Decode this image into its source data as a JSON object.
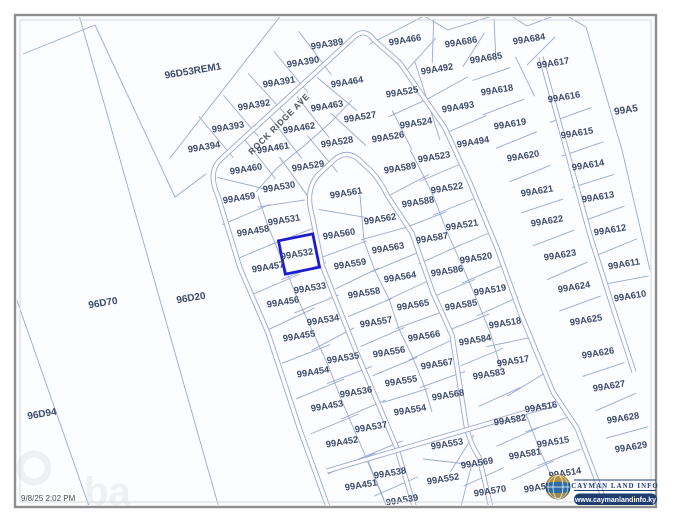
{
  "map": {
    "road_label": "ROCK RIDGE AVE",
    "highlight_parcel": "99A532",
    "colors": {
      "parcel_line": "#9aa8d4",
      "road_fill": "#ffffff",
      "highlight": "#1d1dcf",
      "label_text": "#3e4a6b",
      "frame": "#8e8e8e",
      "logo_navy": "#1e3c6e",
      "globe_blue": "#2d6ca5",
      "globe_gold": "#c9982f"
    },
    "parcels": [
      {
        "id": "96D53REM1",
        "x": 193,
        "y": 71,
        "s": 10
      },
      {
        "id": "96D70",
        "x": 103,
        "y": 303,
        "s": 10
      },
      {
        "id": "96D20",
        "x": 191,
        "y": 298,
        "s": 10
      },
      {
        "id": "96D94",
        "x": 42,
        "y": 414,
        "s": 10
      },
      {
        "id": "99A5",
        "x": 626,
        "y": 110,
        "s": 10
      },
      {
        "id": "99A389",
        "x": 327,
        "y": 44
      },
      {
        "id": "99A390",
        "x": 303,
        "y": 62
      },
      {
        "id": "99A391",
        "x": 279,
        "y": 82
      },
      {
        "id": "99A392",
        "x": 254,
        "y": 105
      },
      {
        "id": "99A393",
        "x": 228,
        "y": 127
      },
      {
        "id": "99A394",
        "x": 204,
        "y": 147
      },
      {
        "id": "99A464",
        "x": 347,
        "y": 82
      },
      {
        "id": "99A463",
        "x": 327,
        "y": 106
      },
      {
        "id": "99A462",
        "x": 299,
        "y": 128
      },
      {
        "id": "99A461",
        "x": 273,
        "y": 148
      },
      {
        "id": "99A460",
        "x": 246,
        "y": 169
      },
      {
        "id": "99A459",
        "x": 239,
        "y": 198
      },
      {
        "id": "99A458",
        "x": 253,
        "y": 231
      },
      {
        "id": "99A457",
        "x": 268,
        "y": 267
      },
      {
        "id": "99A456",
        "x": 283,
        "y": 302
      },
      {
        "id": "99A455",
        "x": 299,
        "y": 336
      },
      {
        "id": "99A454",
        "x": 313,
        "y": 372
      },
      {
        "id": "99A453",
        "x": 327,
        "y": 406
      },
      {
        "id": "99A452",
        "x": 342,
        "y": 442
      },
      {
        "id": "99A451",
        "x": 361,
        "y": 485
      },
      {
        "id": "99A529",
        "x": 308,
        "y": 166
      },
      {
        "id": "99A530",
        "x": 279,
        "y": 187
      },
      {
        "id": "99A531",
        "x": 284,
        "y": 220
      },
      {
        "id": "99A532",
        "x": 297,
        "y": 254
      },
      {
        "id": "99A533",
        "x": 310,
        "y": 288
      },
      {
        "id": "99A534",
        "x": 323,
        "y": 320
      },
      {
        "id": "99A535",
        "x": 343,
        "y": 358
      },
      {
        "id": "99A536",
        "x": 356,
        "y": 392
      },
      {
        "id": "99A537",
        "x": 371,
        "y": 427
      },
      {
        "id": "99A538",
        "x": 390,
        "y": 473
      },
      {
        "id": "99A539",
        "x": 402,
        "y": 500
      },
      {
        "id": "99A527",
        "x": 360,
        "y": 117
      },
      {
        "id": "99A528",
        "x": 337,
        "y": 142
      },
      {
        "id": "99A525",
        "x": 402,
        "y": 92
      },
      {
        "id": "99A524",
        "x": 416,
        "y": 123
      },
      {
        "id": "99A526",
        "x": 388,
        "y": 137
      },
      {
        "id": "99A492",
        "x": 437,
        "y": 69
      },
      {
        "id": "99A493",
        "x": 458,
        "y": 107
      },
      {
        "id": "99A494",
        "x": 473,
        "y": 142
      },
      {
        "id": "99A466",
        "x": 405,
        "y": 40
      },
      {
        "id": "99A686",
        "x": 461,
        "y": 42
      },
      {
        "id": "99A685",
        "x": 486,
        "y": 58
      },
      {
        "id": "99A684",
        "x": 529,
        "y": 39
      },
      {
        "id": "99A561",
        "x": 346,
        "y": 193
      },
      {
        "id": "99A560",
        "x": 339,
        "y": 234
      },
      {
        "id": "99A559",
        "x": 350,
        "y": 264
      },
      {
        "id": "99A558",
        "x": 364,
        "y": 293
      },
      {
        "id": "99A557",
        "x": 376,
        "y": 322
      },
      {
        "id": "99A556",
        "x": 389,
        "y": 352
      },
      {
        "id": "99A555",
        "x": 401,
        "y": 381
      },
      {
        "id": "99A554",
        "x": 410,
        "y": 410
      },
      {
        "id": "99A553",
        "x": 447,
        "y": 444
      },
      {
        "id": "99A552",
        "x": 443,
        "y": 479
      },
      {
        "id": "99A562",
        "x": 380,
        "y": 219
      },
      {
        "id": "99A563",
        "x": 388,
        "y": 248
      },
      {
        "id": "99A564",
        "x": 400,
        "y": 277
      },
      {
        "id": "99A565",
        "x": 413,
        "y": 305
      },
      {
        "id": "99A566",
        "x": 424,
        "y": 336
      },
      {
        "id": "99A567",
        "x": 437,
        "y": 364
      },
      {
        "id": "99A568",
        "x": 448,
        "y": 395
      },
      {
        "id": "99A569",
        "x": 477,
        "y": 463
      },
      {
        "id": "99A570",
        "x": 490,
        "y": 491
      },
      {
        "id": "99A589",
        "x": 400,
        "y": 168
      },
      {
        "id": "99A588",
        "x": 418,
        "y": 202
      },
      {
        "id": "99A587",
        "x": 432,
        "y": 238
      },
      {
        "id": "99A586",
        "x": 447,
        "y": 271
      },
      {
        "id": "99A585",
        "x": 461,
        "y": 305
      },
      {
        "id": "99A584",
        "x": 475,
        "y": 340
      },
      {
        "id": "99A583",
        "x": 489,
        "y": 374
      },
      {
        "id": "99A582",
        "x": 510,
        "y": 420
      },
      {
        "id": "99A581",
        "x": 525,
        "y": 454
      },
      {
        "id": "99A580",
        "x": 540,
        "y": 487
      },
      {
        "id": "99A523",
        "x": 434,
        "y": 157
      },
      {
        "id": "99A522",
        "x": 447,
        "y": 188
      },
      {
        "id": "99A521",
        "x": 462,
        "y": 225
      },
      {
        "id": "99A520",
        "x": 476,
        "y": 258
      },
      {
        "id": "99A519",
        "x": 490,
        "y": 290
      },
      {
        "id": "99A518",
        "x": 505,
        "y": 323
      },
      {
        "id": "99A517",
        "x": 513,
        "y": 361
      },
      {
        "id": "99A516",
        "x": 541,
        "y": 407
      },
      {
        "id": "99A515",
        "x": 553,
        "y": 442
      },
      {
        "id": "99A514",
        "x": 565,
        "y": 473
      },
      {
        "id": "99A617",
        "x": 553,
        "y": 63
      },
      {
        "id": "99A618",
        "x": 497,
        "y": 90
      },
      {
        "id": "99A619",
        "x": 510,
        "y": 124
      },
      {
        "id": "99A620",
        "x": 523,
        "y": 156
      },
      {
        "id": "99A621",
        "x": 537,
        "y": 191
      },
      {
        "id": "99A622",
        "x": 547,
        "y": 221
      },
      {
        "id": "99A623",
        "x": 560,
        "y": 255
      },
      {
        "id": "99A624",
        "x": 574,
        "y": 287
      },
      {
        "id": "99A625",
        "x": 586,
        "y": 320
      },
      {
        "id": "99A616",
        "x": 564,
        "y": 97
      },
      {
        "id": "99A615",
        "x": 577,
        "y": 133
      },
      {
        "id": "99A614",
        "x": 588,
        "y": 165
      },
      {
        "id": "99A613",
        "x": 598,
        "y": 197
      },
      {
        "id": "99A612",
        "x": 610,
        "y": 230
      },
      {
        "id": "99A611",
        "x": 624,
        "y": 264
      },
      {
        "id": "99A610",
        "x": 630,
        "y": 296
      },
      {
        "id": "99A626",
        "x": 598,
        "y": 353
      },
      {
        "id": "99A627",
        "x": 609,
        "y": 386
      },
      {
        "id": "99A628",
        "x": 623,
        "y": 418
      },
      {
        "id": "99A629",
        "x": 631,
        "y": 447
      }
    ]
  },
  "status_bar": {
    "timestamp": "9/8/25 2:02 PM"
  },
  "logo": {
    "title": "CAYMAN LAND INFO",
    "url": "www.caymanlandinfo.ky"
  },
  "watermark": "ba"
}
